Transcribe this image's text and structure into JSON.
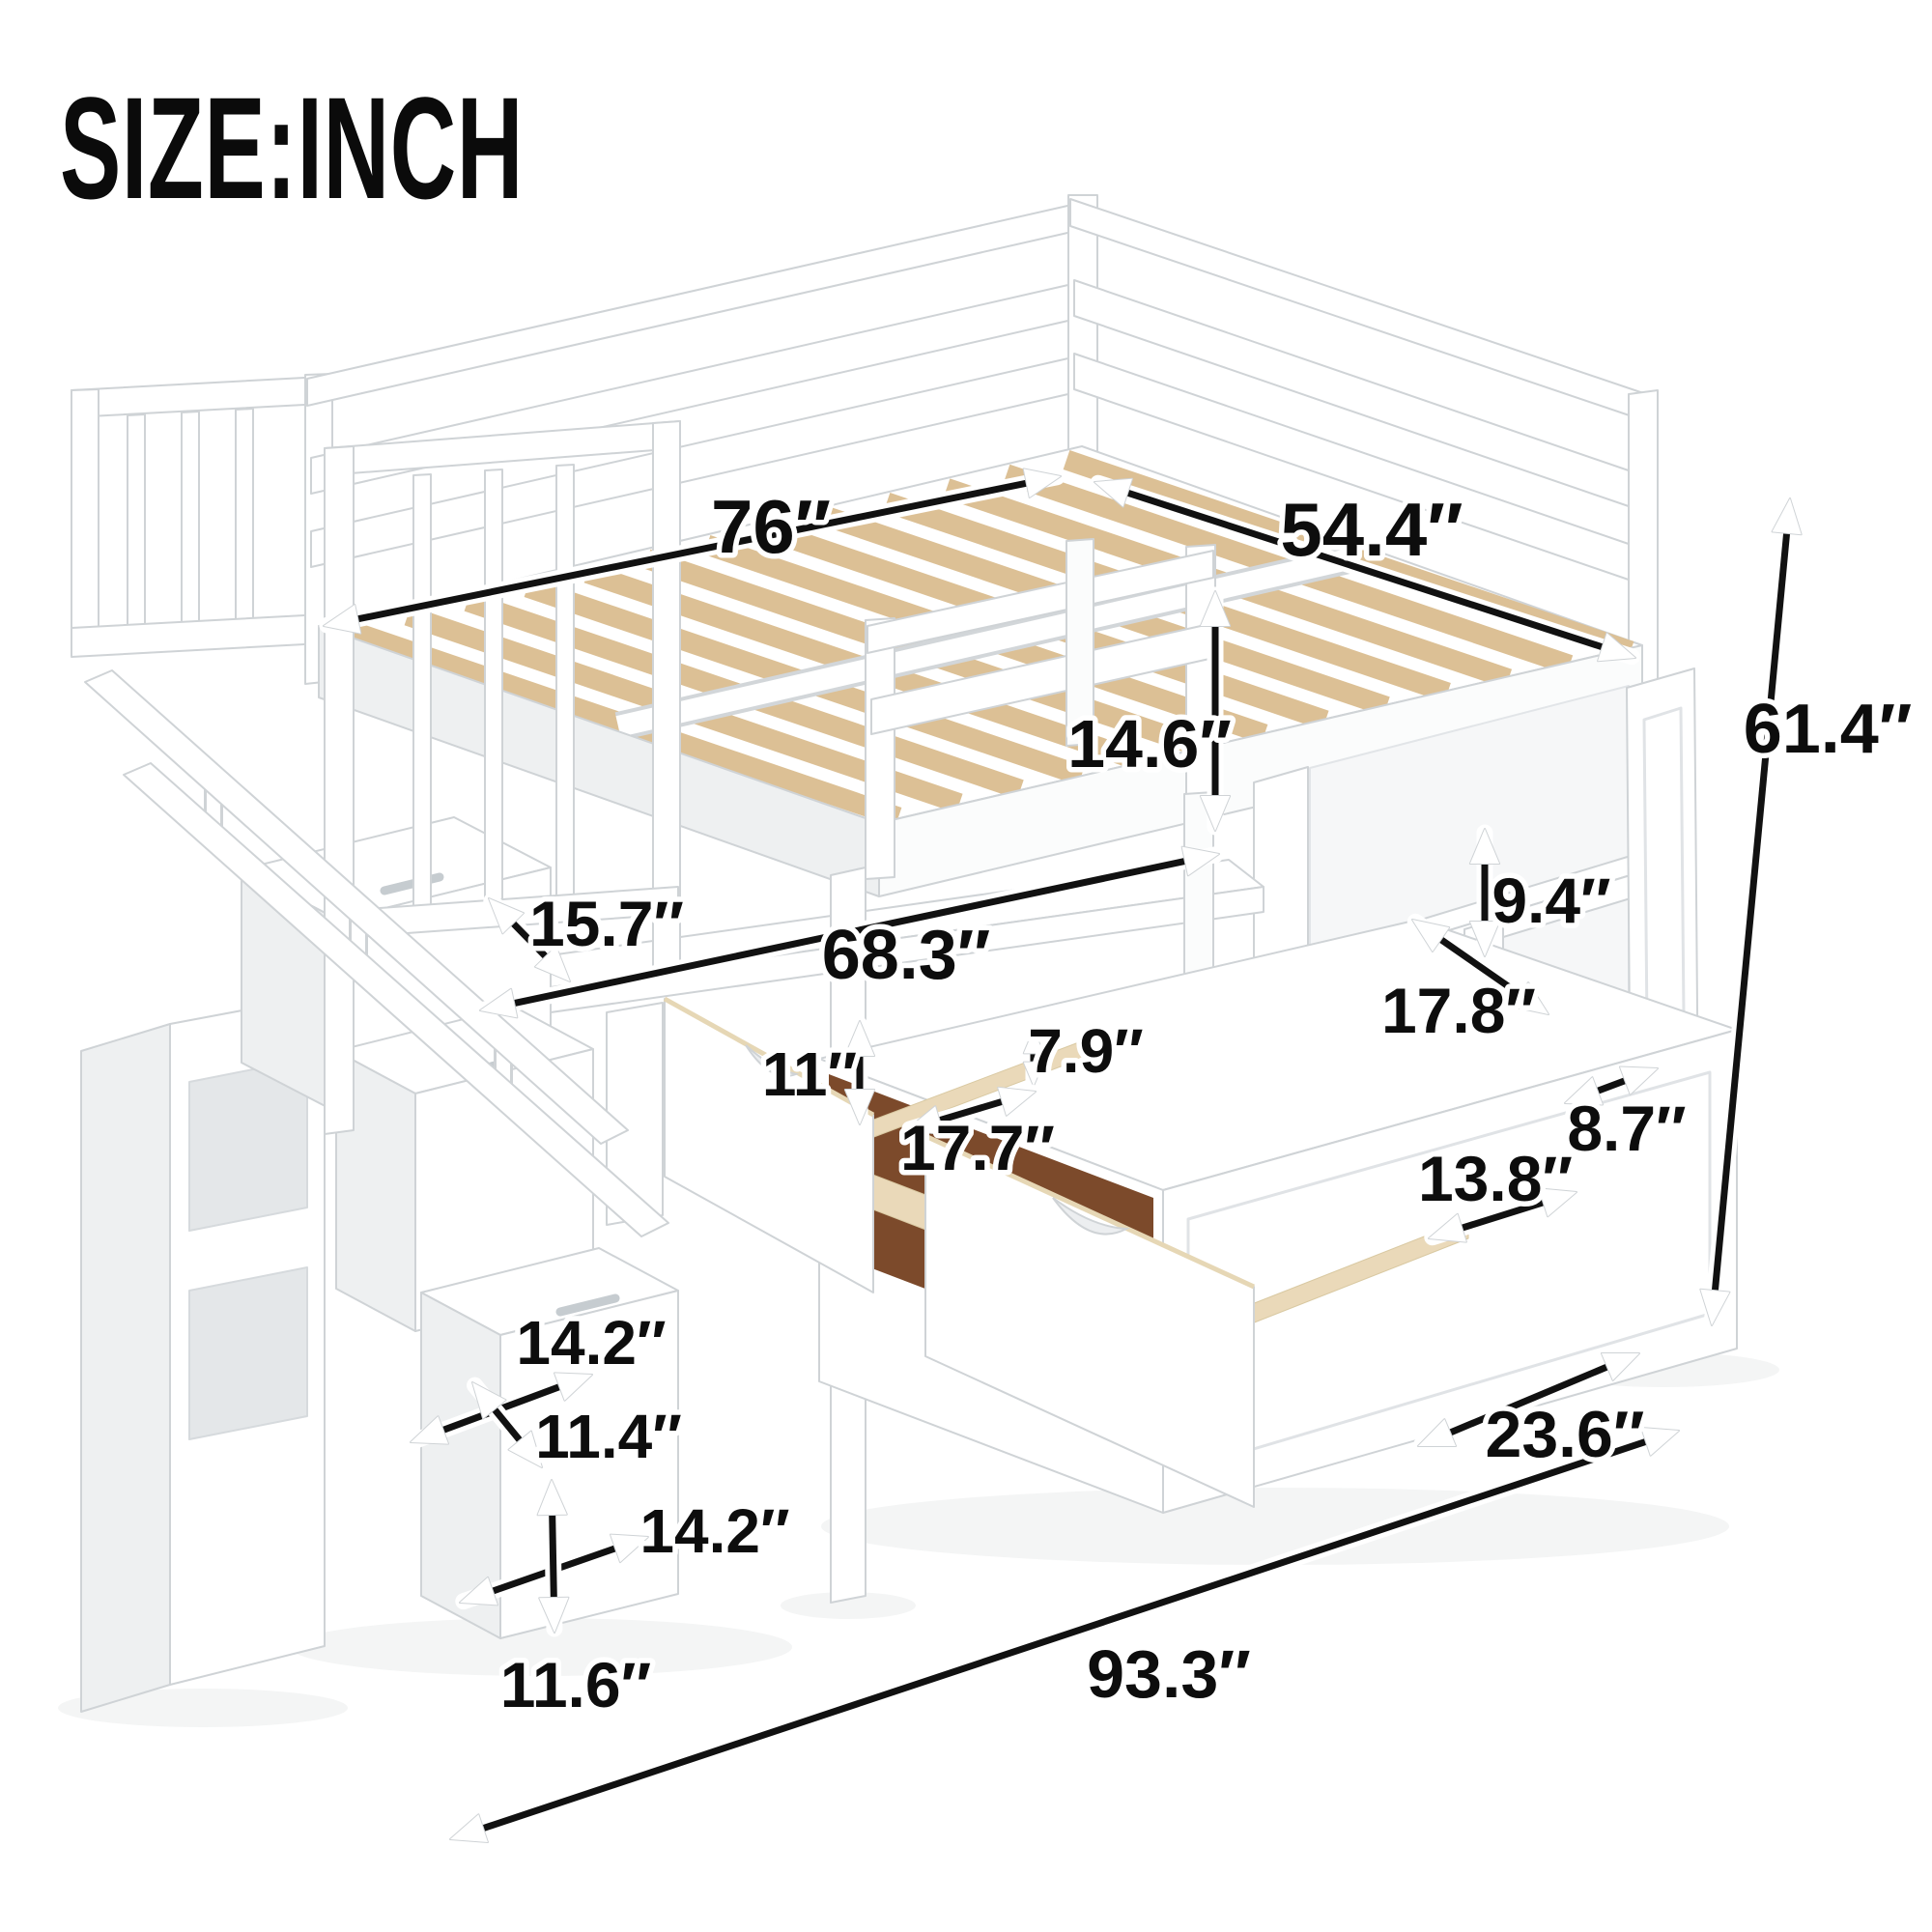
{
  "title": "SIZE:INCH",
  "dimensions": {
    "bed_length": "76″",
    "bed_width": "54.4″",
    "guardrail_height": "14.6″",
    "stair_landing_depth": "15.7″",
    "under_bed_length": "68.3″",
    "cubby_opening_height": "9.4″",
    "cubby_shelf_depth": "17.8″",
    "drawer_front_height": "11″",
    "drawer_opening_height": "7.9″",
    "drawer_depth": "17.7″",
    "side_shelf_depth": "8.7″",
    "bottom_shelf_width": "13.8″",
    "overall_height": "61.4″",
    "step_top_depth": "14.2″",
    "step_width": "11.4″",
    "bottom_step_width": "14.2″",
    "bottom_step_height": "11.6″",
    "storage_depth": "23.6″",
    "overall_length": "93.3″"
  },
  "colors": {
    "arrow": "#111111",
    "label_text": "#0d0d0d",
    "label_halo": "#ffffff",
    "furniture_white": "#ffffff",
    "furniture_outline": "#cfd3d6",
    "slat_wood": "#dcc095",
    "drawer_interior": "#7c4a2b",
    "drawer_plywood": "#ead9b9",
    "background": "#ffffff"
  }
}
